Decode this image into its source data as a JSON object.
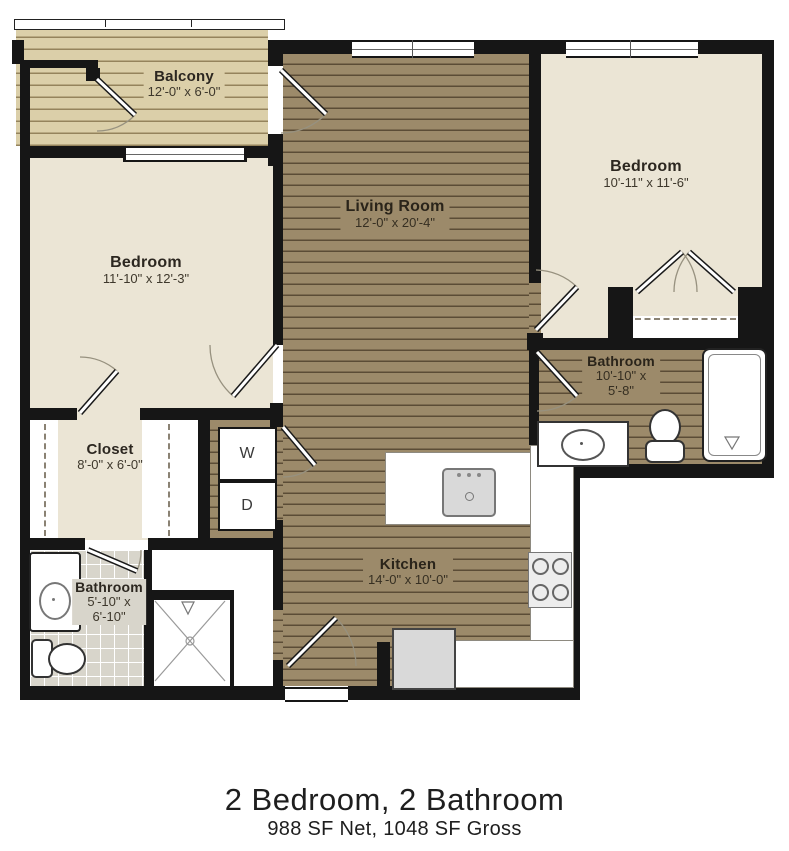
{
  "floor_plan": {
    "caption": {
      "title": "2 Bedroom, 2 Bathroom",
      "subtitle": "988 SF Net, 1048 SF Gross"
    },
    "rooms": {
      "balcony": {
        "name": "Balcony",
        "dims": "12'-0\" x 6'-0\""
      },
      "living_room": {
        "name": "Living Room",
        "dims": "12'-0\" x 20'-4\""
      },
      "bedroom_right": {
        "name": "Bedroom",
        "dims": "10'-11\" x 11'-6\""
      },
      "bedroom_left": {
        "name": "Bedroom",
        "dims": "11'-10\" x 12'-3\""
      },
      "closet": {
        "name": "Closet",
        "dims": "8'-0\" x 6'-0\""
      },
      "bathroom_right": {
        "name": "Bathroom",
        "dims_line1": "10'-10\" x",
        "dims_line2": "5'-8\""
      },
      "bathroom_left": {
        "name": "Bathroom",
        "dims_line1": "5'-10\" x",
        "dims_line2": "6'-10\""
      },
      "kitchen": {
        "name": "Kitchen",
        "dims": "14'-0\" x 10'-0\""
      }
    },
    "appliances": {
      "washer_label": "W",
      "dryer_label": "D"
    },
    "colors": {
      "wall": "#161616",
      "wood_floor": "#9c8a6a",
      "balcony_floor": "#dbcfa9",
      "bedroom_floor": "#ebe5d5",
      "tile_floor": "#d8d5cb"
    }
  }
}
